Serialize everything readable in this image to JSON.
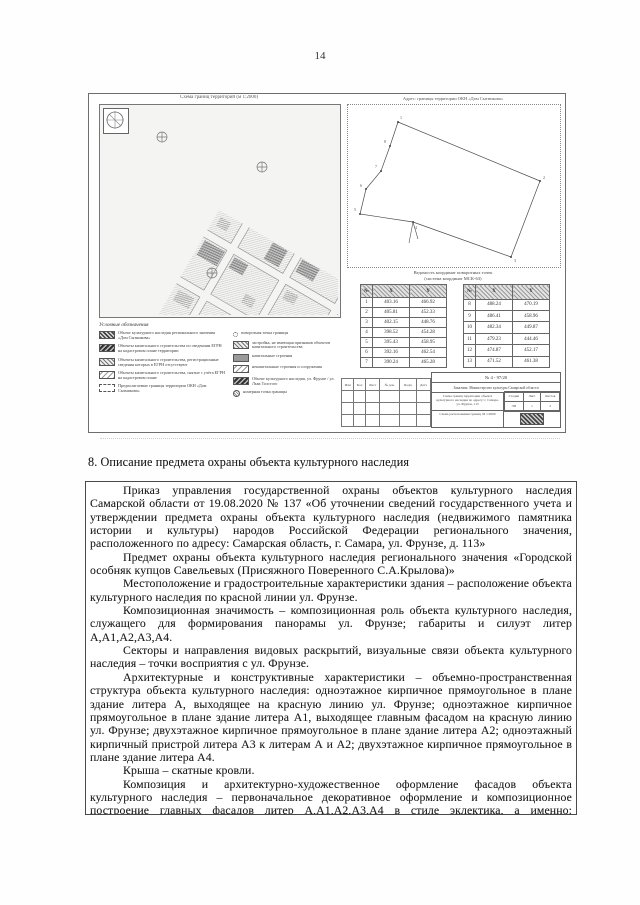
{
  "page": {
    "number": "14"
  },
  "figure": {
    "map_title": "Схема границ территорий (м 1:2000)",
    "diagram_title": "Адрес: границы территории ОКН «Дом Сытникова»",
    "legend": {
      "title": "Условные обозначения",
      "left_items": [
        {
          "swatch": "hatch-dark",
          "label": "Объект культурного наследия регионального значения «Дом Сытникова»"
        },
        {
          "swatch": "hatch-darker",
          "label": "Объекты капитального строительства по сведениям ЕГРН на кадастровом плане территории"
        },
        {
          "swatch": "hatch-mid",
          "label": "Объекты капитального строительства, регистрационные сведения которых в ЕГРН отсутствуют"
        },
        {
          "swatch": "hatch-light",
          "label": "Объекты капитального строительства, снятые с учёта ЕГРН на кадастровом плане"
        },
        {
          "swatch": "dashed-box",
          "label": "Предполагаемые границы территории ОКН «Дом Сытникова»"
        }
      ],
      "right_items": [
        {
          "swatch": "dot",
          "label": "поворотная точка границы"
        },
        {
          "swatch": "hatch-mid",
          "label": "застройка, не имеющая признаков объектов капитального строительства"
        },
        {
          "swatch": "gray",
          "label": "капитальные строения"
        },
        {
          "swatch": "hatch-light",
          "label": "некапитальные строения и сооружения"
        },
        {
          "swatch": "hatch-darker",
          "label": "Объект культурного наследия, ул. Фрунзе / ул. Льва Толстого"
        },
        {
          "swatch": "circle",
          "label": "номерная точка границы"
        }
      ]
    },
    "coords_caption_line1": "Ведомость координат поворотных точек",
    "coords_caption_line2": "(система координат МСК-63)",
    "coord_headers": [
      "№",
      "X",
      "Y"
    ],
    "coord_table_left": [
      [
        "1",
        "403.16",
        "466.92"
      ],
      [
        "2",
        "405.81",
        "452.33"
      ],
      [
        "3",
        "402.15",
        "448.76"
      ],
      [
        "4",
        "398.52",
        "454.28"
      ],
      [
        "5",
        "395.43",
        "458.95"
      ],
      [
        "6",
        "392.16",
        "462.54"
      ],
      [
        "7",
        "390.24",
        "465.28"
      ]
    ],
    "coord_table_right": [
      [
        "8",
        "488.24",
        "470.19"
      ],
      [
        "9",
        "486.41",
        "458.96"
      ],
      [
        "10",
        "482.34",
        "449.87"
      ],
      [
        "11",
        "479.23",
        "444.46"
      ],
      [
        "12",
        "474.87",
        "452.17"
      ],
      [
        "13",
        "471.52",
        "461.38"
      ]
    ],
    "stamp": {
      "doc_number": "№ 4 - 97/20",
      "customer": "Заказчик: Министерство культуры Самарской области",
      "sig_headers": [
        "Изм",
        "Кол",
        "Лист",
        "№ док.",
        "Подп.",
        "Дата"
      ],
      "object_desc": "Схема границ территории объекта культурного наследия по адресу: г. Самара, ул. Фрунзе, 113",
      "mini_headers": [
        "Стадия",
        "Лист",
        "Листов"
      ],
      "mini_values": [
        "ЭП",
        "1",
        "2"
      ],
      "sheet_title": "Схема расположения границ, М 1:2000"
    }
  },
  "section": {
    "heading": "8. Описание предмета охраны объекта культурного наследия"
  },
  "content": {
    "paragraphs": [
      "Приказ управления государственной охраны объектов культурного наследия Самарской области от 19.08.2020 № 137 «Об уточнении сведений государственного учета и утверждении предмета охраны объекта культурного наследия (недвижимого памятника истории и культуры) народов Российской Федерации регионального значения, расположенного по адресу: Самарская область, г. Самара, ул. Фрунзе, д. 113»",
      "Предмет охраны объекта культурного наследия регионального значения «Городской особняк купцов Савельевых (Присяжного Поверенного С.А.Крылова)»",
      "Местоположение и градостроительные характеристики здания – расположение объекта культурного наследия по красной линии ул. Фрунзе.",
      "Композиционная значимость – композиционная роль объекта культурного наследия, служащего для формирования панорамы ул. Фрунзе; габариты и силуэт литер А,А1,А2,А3,А4.",
      "Секторы и направления видовых раскрытий, визуальные связи объекта культурного наследия – точки восприятия с ул. Фрунзе.",
      "Архитектурные и конструктивные характеристики – объемно-пространственная структура объекта культурного наследия: одноэтажное кирпичное прямоугольное в плане здание литера А, выходящее на красную линию ул. Фрунзе; одноэтажное кирпичное прямоугольное в плане здание литера А1, выходящее главным фасадом на красную линию ул. Фрунзе; двухэтажное кирпичное прямоугольное в плане здание литера А2; одноэтажный кирпичный пристрой литера А3 к литерам А и А2; двухэтажное кирпичное прямоугольное в плане здание литера А4.",
      "Крыша – скатные кровли.",
      "Композиция и архитектурно-художественное оформление фасадов объекта культурного наследия – первоначальное декоративное оформление и композиционное построение главных фасадов литер А,А1,А2,А3,А4 в стиле эклектика, а именно: расположение и конфигурация"
    ]
  }
}
